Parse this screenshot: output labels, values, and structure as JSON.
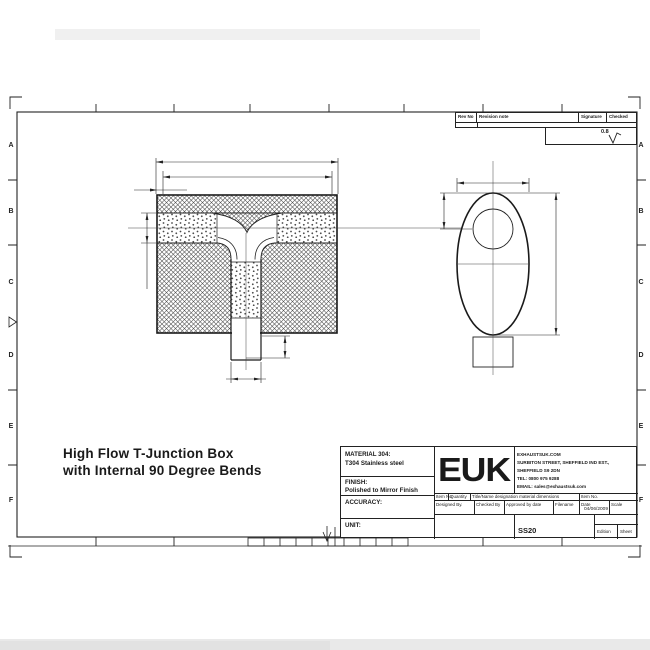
{
  "page": {
    "title_line1": "High Flow T-Junction Box",
    "title_line2": "with Internal 90 Degree Bends"
  },
  "frame": {
    "row_labels": [
      "A",
      "B",
      "C",
      "D",
      "E",
      "F"
    ]
  },
  "revision": {
    "headers": [
      "Rev No",
      "Revision note",
      "Signature",
      "Checked"
    ],
    "surface_finish": "0.8"
  },
  "title_block": {
    "material_label": "MATERIAL 304:",
    "material_value": "T304 Stainless steel",
    "finish_label": "FINISH:",
    "finish_value": "Polished to Mirror Finish",
    "accuracy_label": "ACCURACY:",
    "unit_label": "UNIT:",
    "logo": "EUK",
    "company": {
      "line1": "EXHAUSTSUK.COM",
      "line2": "SURBITON STREET, SHEFFIELD IND EST.,",
      "line3": "SHEFFIELD S9 2DN",
      "line4": "TEL: 0800 975 9288",
      "line5": "EMAIL: sales@exhaustsuk.com"
    },
    "row1": [
      "Item No",
      "Quantity",
      "Title/Name designation material dimensions",
      "Item No."
    ],
    "row2": [
      "Designed By.",
      "Checked By",
      "Approved by date",
      "Filename",
      "Date",
      "Scale"
    ],
    "date_value": "04/06/2009",
    "drawing_number": "SS20",
    "edition_label": "Edition",
    "sheet_label": "Sheet"
  }
}
